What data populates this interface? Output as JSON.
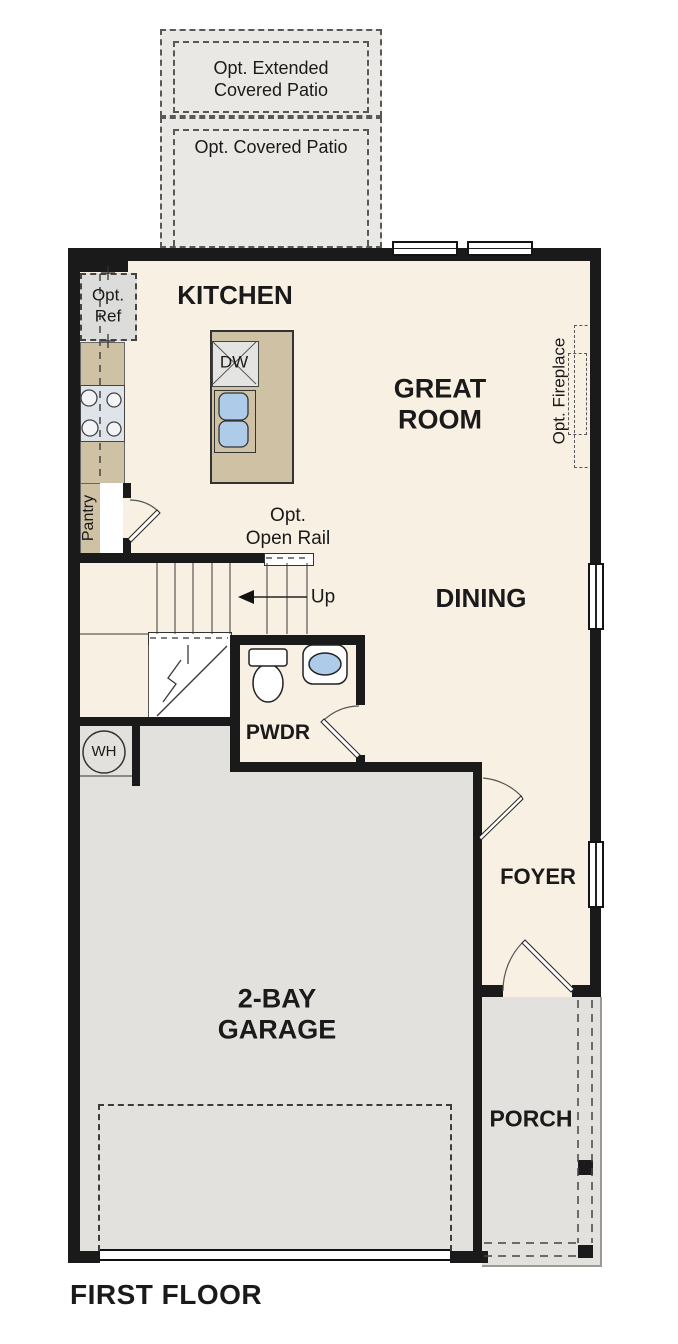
{
  "title": "FIRST FLOOR",
  "colors": {
    "floor": "#f8f0e2",
    "wall": "#1a1a1a",
    "patio": "#e9e8e4",
    "concrete": "#e2e1dd",
    "counter": "#cfc1a4",
    "sink": "#aecbea",
    "appliance": "#e4e4e2",
    "stove": "#dfe4ea"
  },
  "patio": {
    "extended_label": "Opt. Extended\nCovered Patio",
    "covered_label": "Opt. Covered Patio"
  },
  "rooms": {
    "kitchen": "KITCHEN",
    "great_room": "GREAT\nROOM",
    "dining": "DINING",
    "pwdr": "PWDR",
    "foyer": "FOYER",
    "garage": "2-BAY\nGARAGE",
    "porch": "PORCH"
  },
  "features": {
    "opt_ref": "Opt.\nRef",
    "pantry": "Pantry",
    "opt_fireplace": "Opt. Fireplace",
    "opt_open_rail": "Opt.\nOpen Rail",
    "up": "Up",
    "dw": "DW",
    "wh": "WH"
  }
}
